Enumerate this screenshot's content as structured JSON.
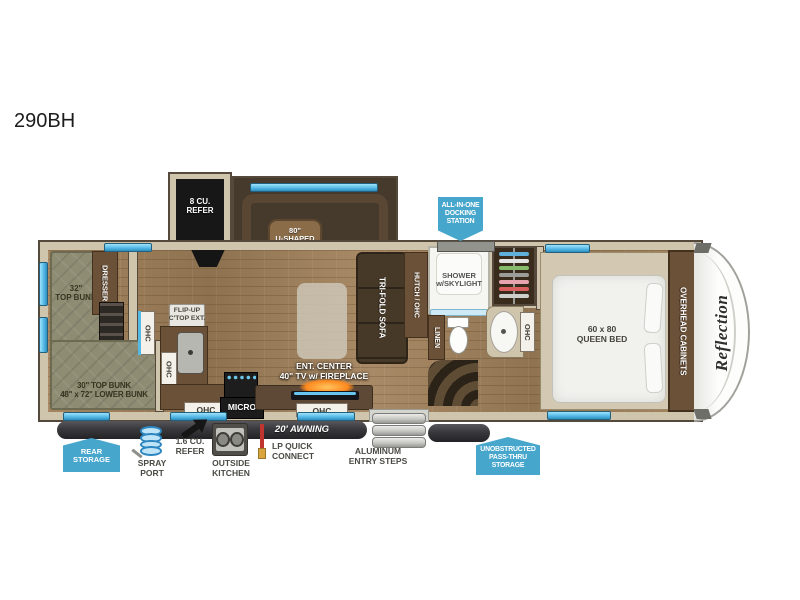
{
  "page": {
    "title": "290BH"
  },
  "logo": {
    "brand": "Reflection"
  },
  "badges": {
    "docking": "ALL-IN-ONE\nDOCKING\nSTATION",
    "rear_storage": "REAR\nSTORAGE",
    "pass_thru": "UNOBSTRUCTED\nPASS-THRU\nSTORAGE"
  },
  "interior": {
    "refer": "8 CU.\nREFER",
    "dinette": "80\"\nU-SHAPED\nDINETTE",
    "shower": "SHOWER\nw/SKYLIGHT",
    "bunk_top_32": "32\"\nTOP BUNK",
    "dresser": "DRESSER",
    "bunk_combo": "30\" TOP BUNK\n48\" x 72\" LOWER BUNK",
    "flip_up_counter": "FLIP-UP\nC'TOP EXT.",
    "sofa": "TRI-FOLD SOFA",
    "hutch": "HUTCH / OHC",
    "linen": "LINEN",
    "queen_bed": "60 x 80\nQUEEN BED",
    "overhead_cabinets": "OVERHEAD CABINETS",
    "ent_center": "ENT. CENTER\n40\" TV w/ FIREPLACE",
    "micro": "MICRO",
    "ohc": "OHC"
  },
  "exterior": {
    "awning": "20' AWNING",
    "entry_steps": "ALUMINUM\nENTRY STEPS",
    "spray_port": "SPRAY\nPORT",
    "outside_refer": "1.6 CU.\nREFER",
    "outside_kitchen": "OUTSIDE\nKITCHEN",
    "lp_connect": "LP QUICK\nCONNECT"
  },
  "closet": {
    "hanger_colors": [
      "#5fb0da",
      "#e4e4e2",
      "#85bb6a",
      "#9c9c98",
      "#e8a4ae",
      "#d9605e",
      "#cfcfcb"
    ]
  },
  "colors": {
    "badge_blue": "#47a6cc",
    "window_blue": "#55b9e6",
    "wall_tan": "#cfc4ac",
    "wood_floor": "#9c7e5d",
    "cabinet_brown": "#6b5138",
    "bunk_olive": "#8f8c74",
    "appliance_black": "#1c1c1c"
  }
}
